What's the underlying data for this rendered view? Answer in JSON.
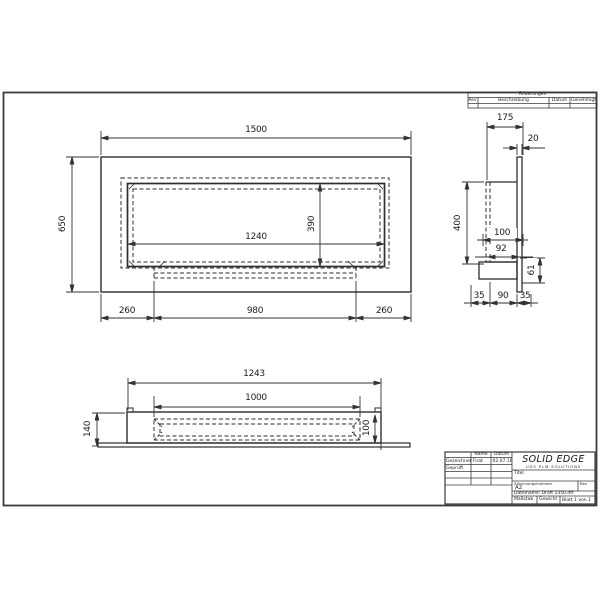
{
  "revision_table": {
    "header": "Änderungen",
    "columns": {
      "rev": "Rev",
      "description": "Beschreibung",
      "date": "Datum",
      "approved": "Genehmigt"
    }
  },
  "title_block": {
    "software": "SOLID EDGE",
    "software_sub": "UGS PLM SOLUTIONS",
    "name_col": "Name",
    "date_col": "Datum",
    "drawn_label": "Gezeichnet",
    "drawn_name": "Firat",
    "drawn_date": "02.07.16",
    "checked_label": "Geprüft",
    "title_label": "Titel",
    "docnum_label": "Zeichnungsnummer",
    "sheet_size": "A2",
    "rev_label": "Rev",
    "file_text": "Dateiname: Draft 1350.dft",
    "scale_label": "Maßstab",
    "weight_label": "Gewicht",
    "sheet_text": "Blatt 1 von 1"
  },
  "dimensions": {
    "front": {
      "overall_width": "1500",
      "overall_height": "650",
      "opening_width": "1240",
      "opening_height": "390",
      "left_offset": "260",
      "center_width": "980",
      "right_offset": "260"
    },
    "side": {
      "depth": "175",
      "panel_thickness": "20",
      "box_height": "400",
      "depth_100": "100",
      "depth_92": "92",
      "height_61": "61",
      "left_35": "35",
      "middle_90": "90",
      "right_35": "35"
    },
    "top": {
      "body_width": "1243",
      "burner_width": "1000",
      "depth_140": "140",
      "inner_depth_100": "100"
    }
  }
}
